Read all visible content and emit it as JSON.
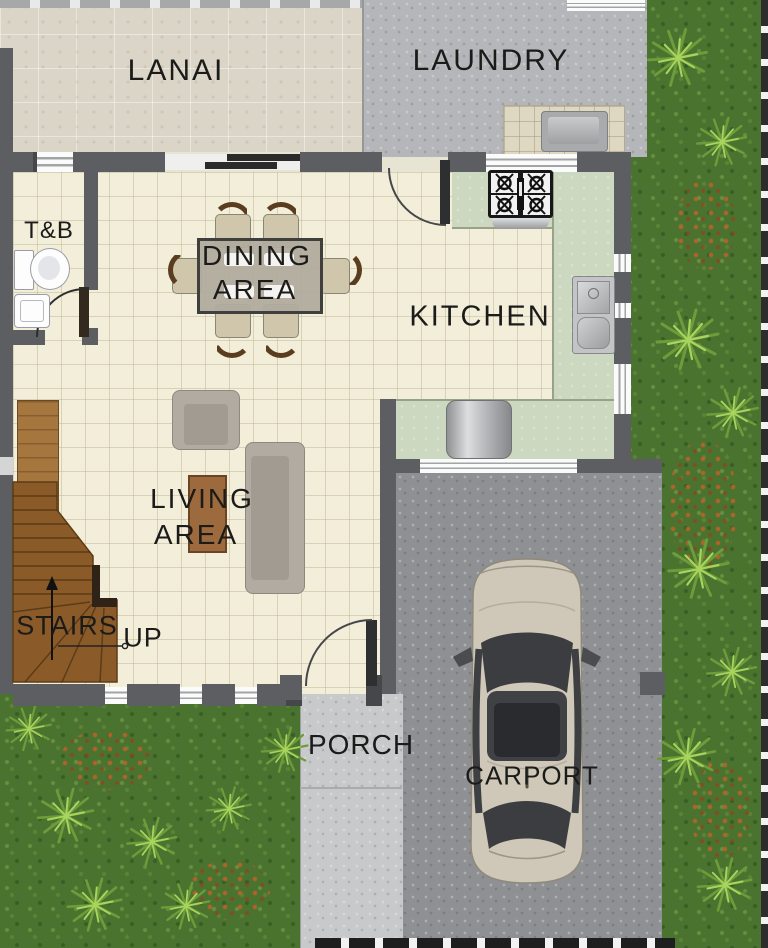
{
  "labels": {
    "lanai": "LANAI",
    "laundry": "LAUNDRY",
    "toilet_bath": "T&B",
    "dining_line1": "DINING",
    "dining_line2": "AREA",
    "kitchen": "KITCHEN",
    "living_line1": "LIVING",
    "living_line2": "AREA",
    "stairs": "STAIRS",
    "stairs_direction": "UP",
    "porch": "PORCH",
    "carport": "CARPORT"
  },
  "colors": {
    "wall": "#5c5e62",
    "floor_tile_cream": "#f2eeda",
    "lanai_floor": "#dad5c6",
    "laundry_concrete": "#b5b6b9",
    "kitchen_counter_green": "#ccd8c0",
    "bathroom_tile_blue": "#8d9cc2",
    "grass_green": "#4a7330",
    "porch_concrete": "#c7c9cb",
    "carport_asphalt": "#8e9093",
    "stair_wood": "#8a5b29",
    "car_body": "#cfc8b8",
    "label_text": "#1b1b19"
  }
}
